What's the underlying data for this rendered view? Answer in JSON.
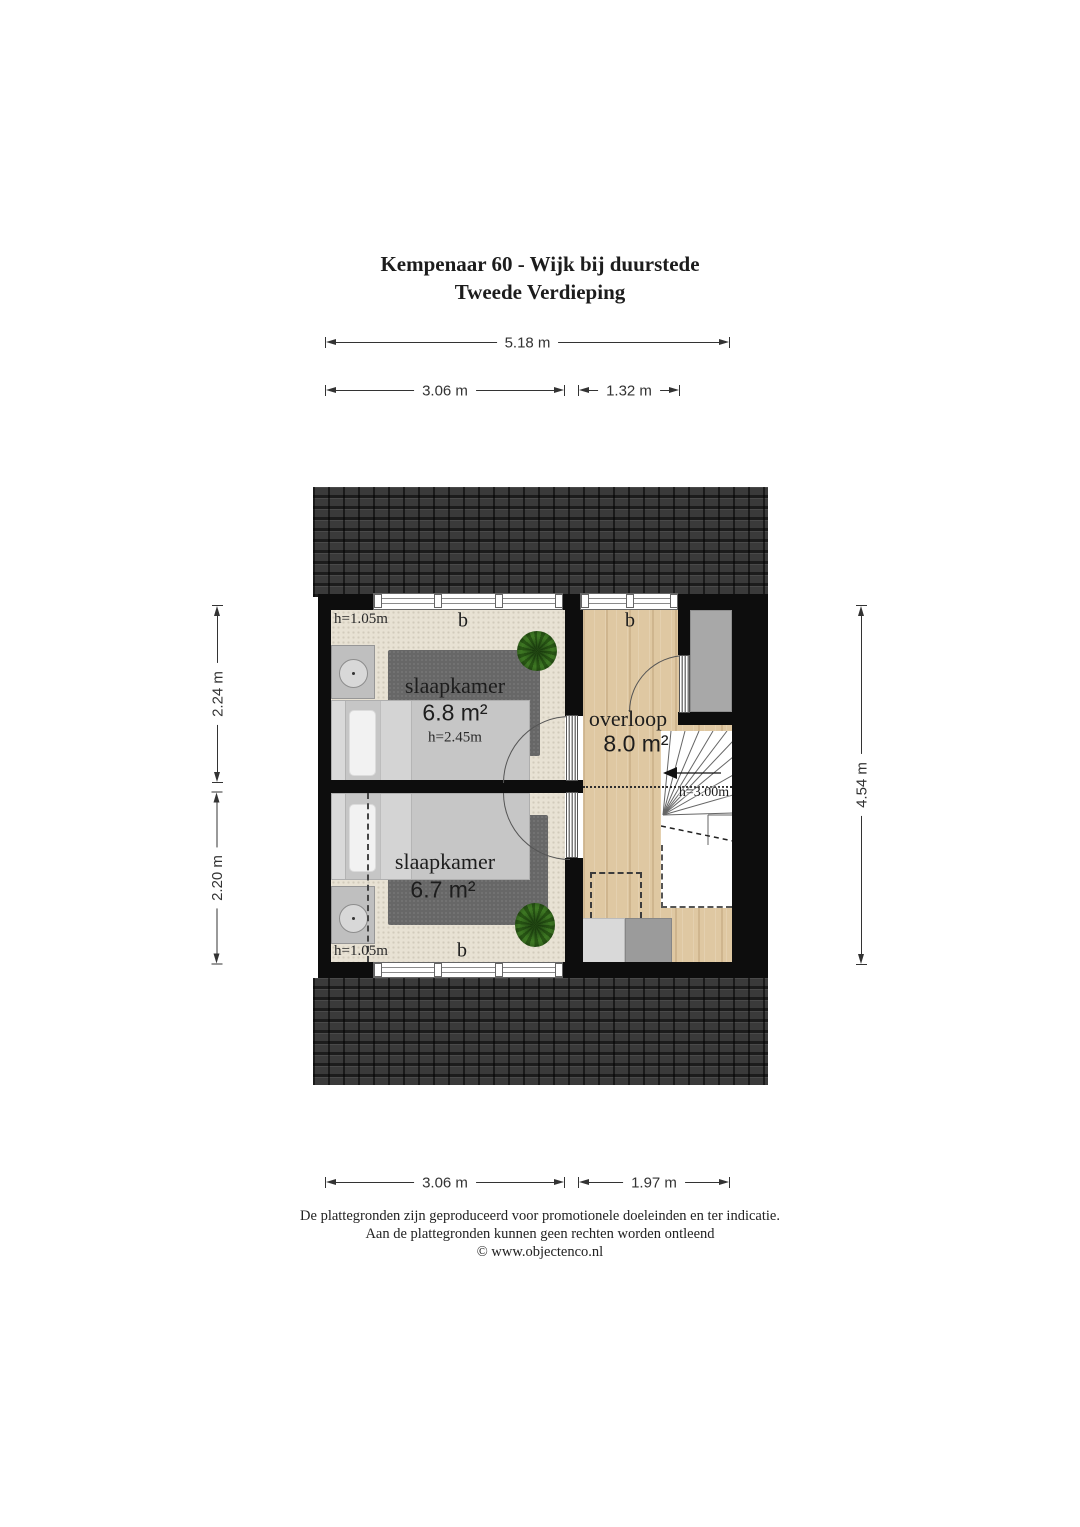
{
  "title": {
    "line1": "Kempenaar 60 - Wijk bij duurstede",
    "line2": "Tweede Verdieping"
  },
  "dimensions": {
    "top_width": "5.18 m",
    "top_left": "3.06 m",
    "top_right": "1.32 m",
    "side_left_upper": "2.24 m",
    "side_left_lower": "2.20 m",
    "side_right": "4.54 m",
    "bottom_left": "3.06 m",
    "bottom_right": "1.97 m"
  },
  "rooms": {
    "bedroom_top": {
      "name": "slaapkamer",
      "area": "6.8 m²",
      "ceiling_height": "h=2.45m",
      "knee_height": "h=1.05m",
      "window_label": "b"
    },
    "bedroom_bottom": {
      "name": "slaapkamer",
      "area": "6.7 m²",
      "knee_height": "h=1.05m",
      "window_label": "b"
    },
    "landing": {
      "name": "overloop",
      "area": "8.0 m²",
      "window_label": "b"
    },
    "stairs": {
      "height": "h=3.00m"
    }
  },
  "footer": {
    "line1": "De plattegronden zijn geproduceerd voor promotionele doeleinden en ter indicatie.",
    "line2": "Aan de plattegronden kunnen geen rechten worden ontleend",
    "line3": "© www.objectenco.nl"
  },
  "colors": {
    "roof": "#2c2c2c",
    "wall": "#0d0d0d",
    "carpet": "#e8e2d4",
    "wood": "#dfc8a2",
    "rug": "#676767",
    "plant": "#3f7a24",
    "closet": "#a8a8a8",
    "dim_line": "#333333"
  }
}
